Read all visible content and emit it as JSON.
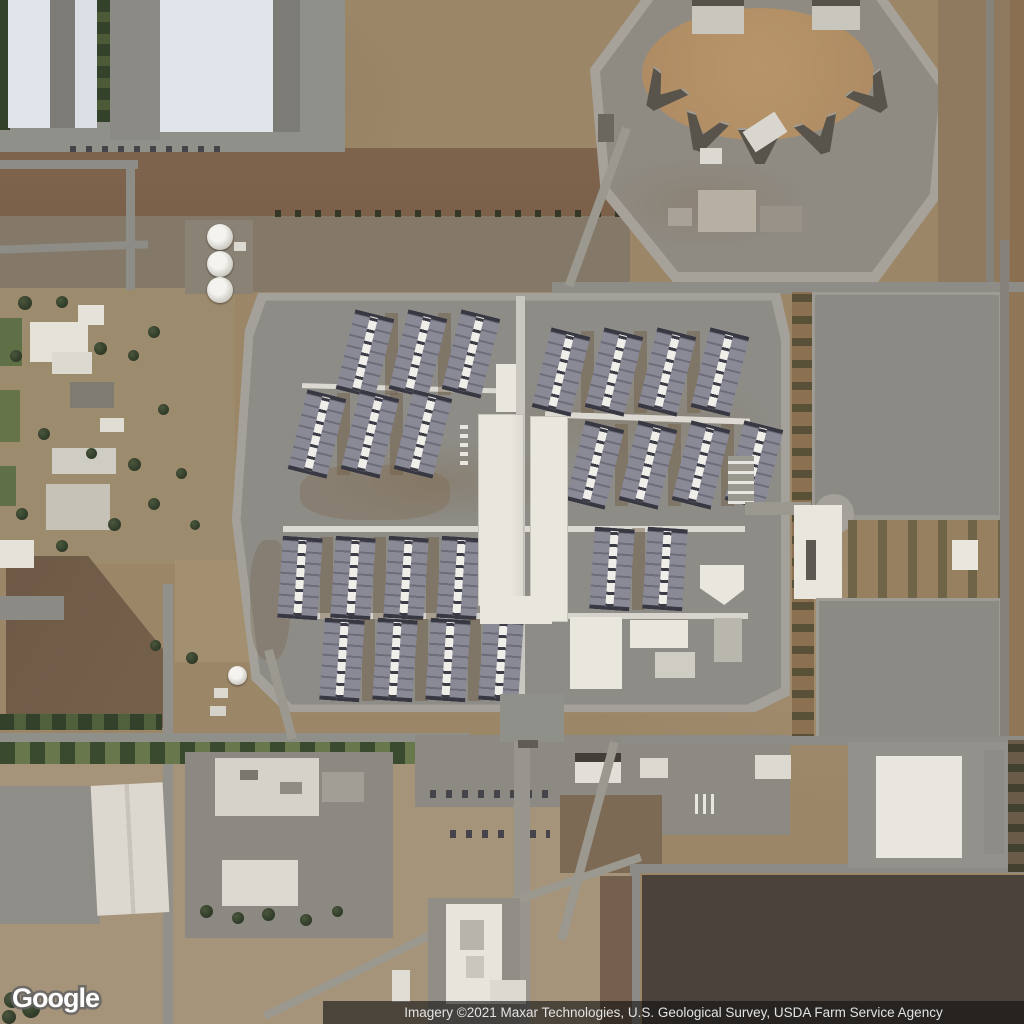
{
  "map": {
    "view_type": "satellite",
    "logo_text": "Google",
    "attribution_text": "Imagery ©2021 Maxar Technologies, U.S. Geological Survey, USDA Farm Service Agency"
  },
  "colors": {
    "dirt_base": "#9c8668",
    "dirt_red_band": "#7b604a",
    "dirt_gray_band": "#847968",
    "dirt_dark_field": "#6b5743",
    "dirt_pale": "#a5937a",
    "field_dark": "#4a423b",
    "pavement": "#8d8c86",
    "pavement_light": "#a3a19a",
    "pavement_dark": "#7d7b75",
    "concrete": "#e9e6de",
    "warehouse_roof": "#dfe5ea",
    "barrack_roof": "#8a8a97",
    "barrack_dark": "#383842",
    "tree_dark": "#2e3927",
    "grass": "#5f7046",
    "yard_brown": "#ad8a62",
    "vbuilding": "#59544b",
    "attr_bg": "rgba(15,15,15,0.60)",
    "attr_text": "#e3e3e3",
    "logo_outline": "#6b6b6b"
  }
}
